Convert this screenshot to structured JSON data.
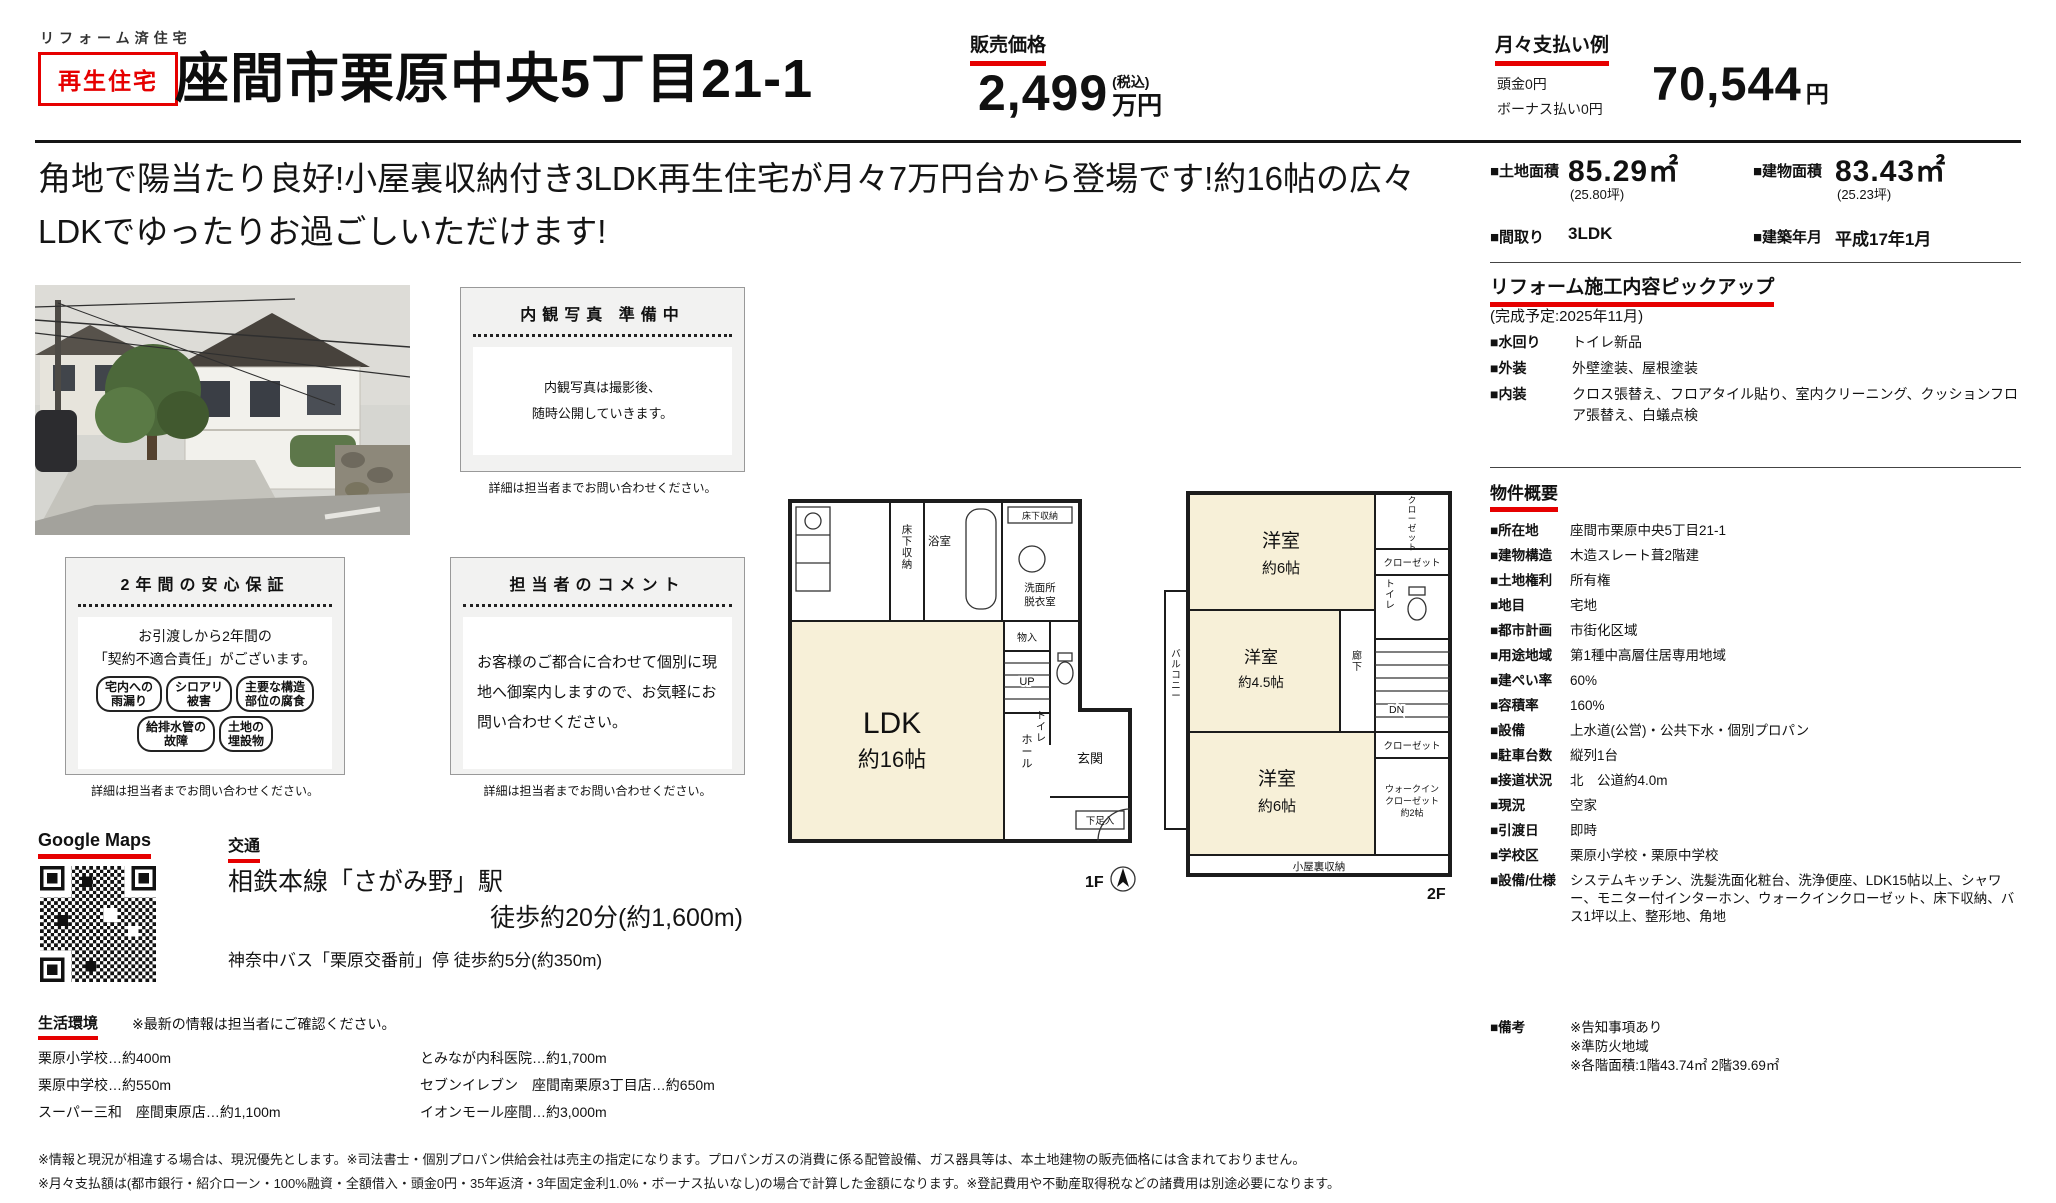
{
  "colors": {
    "accent_red": "#e60000",
    "room_cream": "#f7f0d8"
  },
  "header": {
    "small_label": "リフォーム済住宅",
    "badge": "再生住宅",
    "title": "座間市栗原中央5丁目21-1",
    "price_label": "販売価格",
    "price_value": "2,499",
    "price_tax": "(税込)",
    "price_unit": "万円",
    "monthly_label": "月々支払い例",
    "down_payment": "頭金0円",
    "bonus_payment": "ボーナス払い0円",
    "monthly_value": "70,544",
    "monthly_unit": "円"
  },
  "catch_copy": {
    "line1": "角地で陽当たり良好!小屋裏収納付き3LDK再生住宅が月々7万円台から登場です!約16帖の広々",
    "line2": "LDKでゆったりお過ごしいただけます!"
  },
  "spec_summary": {
    "land_label": "■土地面積",
    "land_value": "85.29㎡",
    "land_tsubo": "(25.80坪)",
    "bldg_label": "■建物面積",
    "bldg_value": "83.43㎡",
    "bldg_tsubo": "(25.23坪)",
    "madori_label": "■間取り",
    "madori_value": "3LDK",
    "built_label": "■建築年月",
    "built_value": "平成17年1月"
  },
  "reform": {
    "title": "リフォーム施工内容ピックアップ",
    "schedule": "(完成予定:2025年11月)",
    "items": [
      {
        "label": "■水回り",
        "value": "トイレ新品"
      },
      {
        "label": "■外装",
        "value": "外壁塗装、屋根塗装"
      },
      {
        "label": "■内装",
        "value": "クロス張替え、フロアタイル貼り、室内クリーニング、クッションフロア張替え、白蟻点検"
      }
    ]
  },
  "outline": {
    "title": "物件概要",
    "items": [
      {
        "label": "■所在地",
        "value": "座間市栗原中央5丁目21-1"
      },
      {
        "label": "■建物構造",
        "value": "木造スレート葺2階建"
      },
      {
        "label": "■土地権利",
        "value": "所有権"
      },
      {
        "label": "■地目",
        "value": "宅地"
      },
      {
        "label": "■都市計画",
        "value": "市街化区域"
      },
      {
        "label": "■用途地域",
        "value": "第1種中高層住居専用地域"
      },
      {
        "label": "■建ぺい率",
        "value": "60%"
      },
      {
        "label": "■容積率",
        "value": "160%"
      },
      {
        "label": "■設備",
        "value": "上水道(公営)・公共下水・個別プロパン"
      },
      {
        "label": "■駐車台数",
        "value": "縦列1台"
      },
      {
        "label": "■接道状況",
        "value": "北　公道約4.0m"
      },
      {
        "label": "■現況",
        "value": "空家"
      },
      {
        "label": "■引渡日",
        "value": "即時"
      },
      {
        "label": "■学校区",
        "value": "栗原小学校・栗原中学校"
      },
      {
        "label": "■設備/仕様",
        "value": "システムキッチン、洗髪洗面化粧台、洗浄便座、LDK15帖以上、シャワー、モニター付インターホン、ウォークインクローゼット、床下収納、バス1坪以上、整形地、角地"
      }
    ],
    "remarks_label": "■備考",
    "remarks_value": "※告知事項あり\n※準防火地域\n※各階面積:1階43.74㎡ 2階39.69㎡"
  },
  "interior_box": {
    "title": "内観写真 準備中",
    "body_line1": "内観写真は撮影後、",
    "body_line2": "随時公開していきます。",
    "caption": "詳細は担当者までお問い合わせください。"
  },
  "warranty_box": {
    "title": "2年間の安心保証",
    "body_line1": "お引渡しから2年間の",
    "body_line2": "「契約不適合責任」がございます。",
    "pills": [
      "宅内への\n雨漏り",
      "シロアリ\n被害",
      "主要な構造\n部位の腐食",
      "給排水管の\n故障",
      "土地の\n埋設物"
    ],
    "caption": "詳細は担当者までお問い合わせください。"
  },
  "comment_box": {
    "title": "担当者のコメント",
    "body": "お客様のご都合に合わせて個別に現地へ御案内しますので、お気軽にお問い合わせください。",
    "caption": "詳細は担当者までお問い合わせください。"
  },
  "map": {
    "label": "Google Maps"
  },
  "access": {
    "title": "交通",
    "train_line1": "相鉄本線「さがみ野」駅",
    "train_line2": "徒歩約20分(約1,600m)",
    "bus": "神奈中バス「栗原交番前」停 徒歩約5分(約350m)"
  },
  "environment": {
    "title": "生活環境",
    "note": "※最新の情報は担当者にご確認ください。",
    "col1": [
      "栗原小学校…約400m",
      "栗原中学校…約550m",
      "スーパー三和　座間東原店…約1,100m"
    ],
    "col2": [
      "とみなが内科医院…約1,700m",
      "セブンイレブン　座間南栗原3丁目店…約650m",
      "イオンモール座間…約3,000m"
    ]
  },
  "footer": {
    "line1": "※情報と現況が相違する場合は、現況優先とします。※司法書士・個別プロパン供給会社は売主の指定になります。プロパンガスの消費に係る配管設備、ガス器具等は、本土地建物の販売価格には含まれておりません。",
    "line2": "※月々支払額は(都市銀行・紹介ローン・100%融資・全額借入・頭金0円・35年返済・3年固定金利1.0%・ボーナス払いなし)の場合で計算した金額になります。※登記費用や不動産取得税などの諸費用は別途必要になります。"
  },
  "floorplan": {
    "f1": {
      "floor_label": "1F",
      "ldk_line1": "LDK",
      "ldk_line2": "約16帖",
      "bath": "浴室",
      "underfloor": "床下収納",
      "underfloor_small": "床下収納",
      "washroom_line1": "洗面所",
      "washroom_line2": "脱衣室",
      "monoire": "物入",
      "toilet": "トイレ",
      "up": "UP",
      "hall": "ホール",
      "genkan": "玄関",
      "getabako": "下足入"
    },
    "f2": {
      "floor_label": "2F",
      "room_top_line1": "洋室",
      "room_top_line2": "約6帖",
      "room_mid_line1": "洋室",
      "room_mid_line2": "約4.5帖",
      "room_bottom_line1": "洋室",
      "room_bottom_line2": "約6帖",
      "closet_tall": "クローゼット",
      "closet_a": "クローゼット",
      "closet_b": "クローゼット",
      "toilet": "トイレ",
      "hallway": "廊下",
      "dn": "DN",
      "balcony": "バルコニー",
      "wic_line1": "ウォークイン",
      "wic_line2": "クローゼット",
      "wic_line3": "約2帖",
      "attic": "小屋裏収納"
    }
  }
}
